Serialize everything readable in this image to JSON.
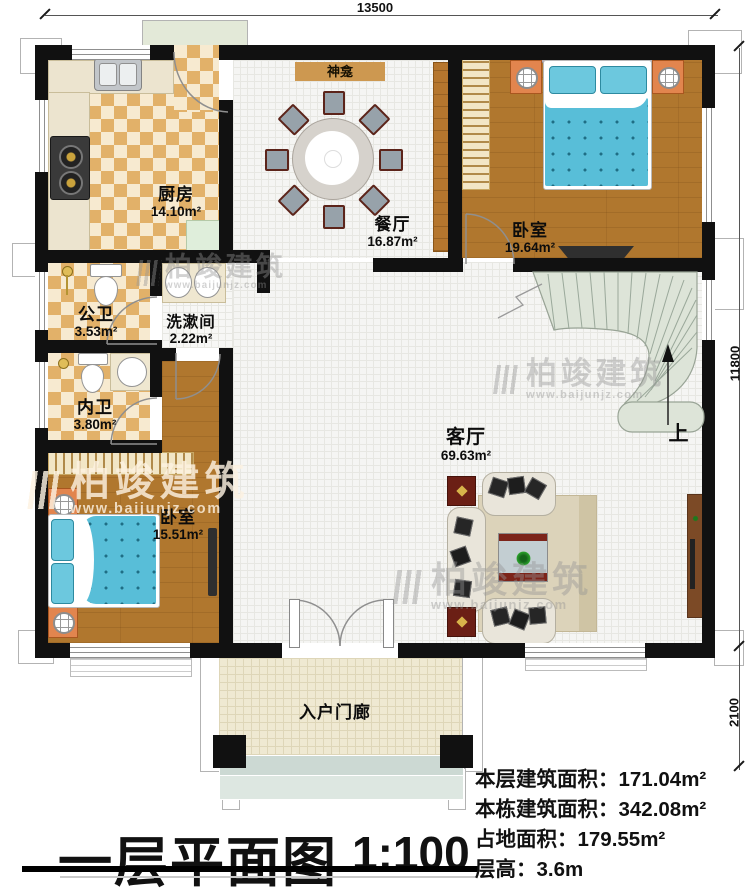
{
  "dimensions": {
    "width_top": "13500",
    "height_right_main": "11800",
    "height_right_porch": "2100"
  },
  "rooms": {
    "kitchen": {
      "name": "厨房",
      "area": "14.10m²"
    },
    "dining": {
      "name": "餐厅",
      "area": "16.87m²"
    },
    "bedroom_top": {
      "name": "卧室",
      "area": "19.64m²"
    },
    "public_bath": {
      "name": "公卫",
      "area": "3.53m²"
    },
    "washroom": {
      "name": "洗漱间",
      "area": "2.22m²"
    },
    "private_bath": {
      "name": "内卫",
      "area": "3.80m²"
    },
    "bedroom_left": {
      "name": "卧室",
      "area": "15.51m²"
    },
    "living": {
      "name": "客厅",
      "area": "69.63m²"
    },
    "porch": {
      "name": "入户门廊"
    },
    "shrine": {
      "name": "神龛"
    },
    "stairs": {
      "up_label": "上"
    }
  },
  "title": {
    "text": "一层平面图",
    "scale": "1:100"
  },
  "stats": [
    {
      "label": "本层建筑面积：",
      "value": "171.04m²"
    },
    {
      "label": "本栋建筑面积：",
      "value": "342.08m²"
    },
    {
      "label": "占地面积：",
      "value": "179.55m²"
    },
    {
      "label": "层高：",
      "value": "3.6m"
    }
  ],
  "watermark": {
    "brand": "柏竣建筑",
    "url": "www.baijunjz.com"
  },
  "colors": {
    "wall": "#111111",
    "wood_floor": "#b0772e",
    "checker_tile": "#e2b169",
    "bed_blue": "#58bed8",
    "stair_green": "#dde4d8",
    "shrine_tan": "#cd9850",
    "nightstand_orange": "#e2854e",
    "side_table_red": "#6b1f15",
    "watermark_gray": "#969696"
  }
}
